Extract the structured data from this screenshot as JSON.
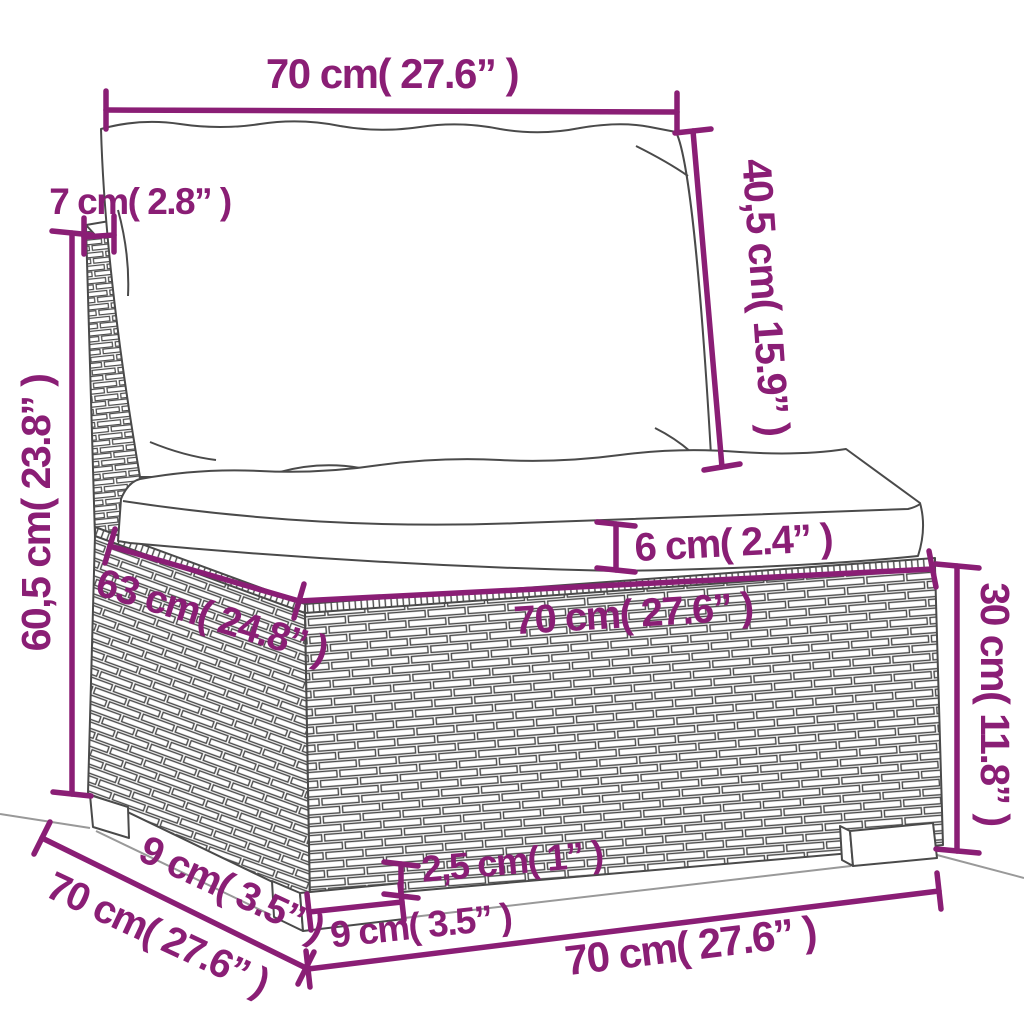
{
  "depicts": "line-art drawing of a poly rattan garden sofa middle section with a back cushion and a seat cushion, annotated with measurements",
  "colors": {
    "background": "#ffffff",
    "annotation": "#8a1e75",
    "line_art": "#4a4a4a",
    "ground": "#999999"
  },
  "dimensions": {
    "back_cushion_width": {
      "label": "70 cm( 27.6” )",
      "cm": "70",
      "inch": "27.6"
    },
    "back_panel_thickness": {
      "label": "7 cm( 2.8” )",
      "cm": "7",
      "inch": "2.8"
    },
    "backrest_height": {
      "label": "40,5 cm( 15.9” )",
      "cm": "40,5",
      "inch": "15.9"
    },
    "overall_height": {
      "label": "60,5 cm( 23.8” )",
      "cm": "60,5",
      "inch": "23.8"
    },
    "seat_depth": {
      "label": "63 cm( 24.8” )",
      "cm": "63",
      "inch": "24.8"
    },
    "seat_cushion_thickness": {
      "label": "6 cm( 2.4” )",
      "cm": "6",
      "inch": "2.4"
    },
    "seat_width": {
      "label": "70 cm( 27.6” )",
      "cm": "70",
      "inch": "27.6"
    },
    "base_height": {
      "label": "30 cm( 11.8” )",
      "cm": "30",
      "inch": "11.8"
    },
    "foot_height": {
      "label": "2,5 cm( 1” )",
      "cm": "2,5",
      "inch": "1"
    },
    "front_foot_width": {
      "label": "9 cm( 3.5” )",
      "cm": "9",
      "inch": "3.5"
    },
    "side_foot_depth": {
      "label": "9 cm( 3.5” )",
      "cm": "9",
      "inch": "3.5"
    },
    "side_depth": {
      "label": "70 cm( 27.6” )",
      "cm": "70",
      "inch": "27.6"
    },
    "bottom_front_width": {
      "label": "70 cm( 27.6” )",
      "cm": "70",
      "inch": "27.6"
    }
  }
}
